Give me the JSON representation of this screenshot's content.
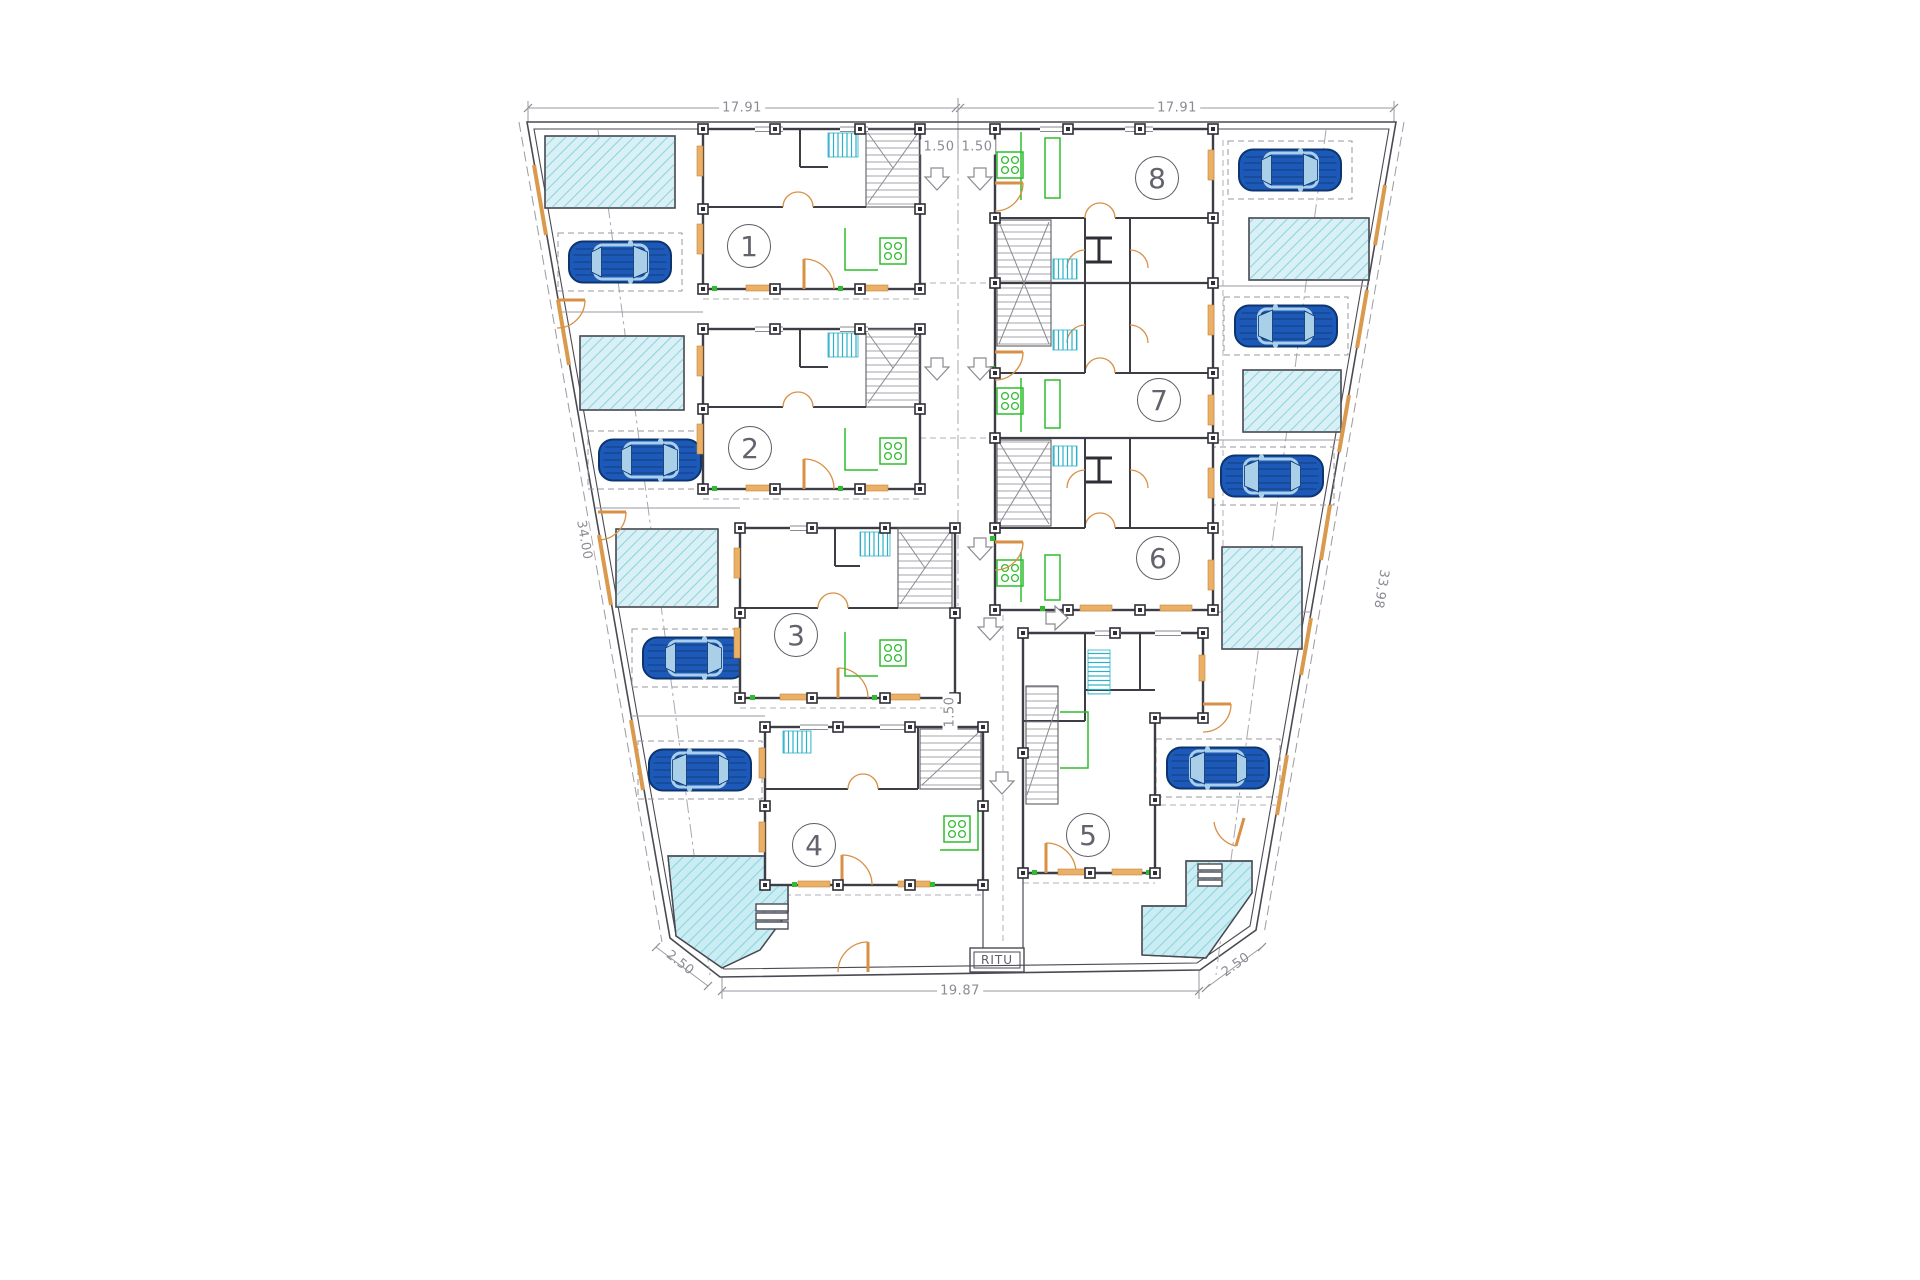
{
  "title": "Residential site plan - ground floor with 8 units",
  "units": {
    "u1": "1",
    "u2": "2",
    "u3": "3",
    "u4": "4",
    "u5": "5",
    "u6": "6",
    "u7": "7",
    "u8": "8"
  },
  "dimensions": {
    "top_left": "17.91",
    "top_right": "17.91",
    "setback_left": "1.50",
    "setback_right": "1.50",
    "side_left": "34.00",
    "side_right": "33,98",
    "center_gap": "1.50",
    "bottom": "19.87",
    "cut_left": "2.50",
    "cut_right": "2.50"
  },
  "labels": {
    "utility_box": "RITU"
  },
  "icons": {
    "car": "car-top-view-icon",
    "entry_arrow": "entry-direction-arrow-icon",
    "stairs": "staircase-icon",
    "stove": "kitchen-stove-icon",
    "pool": "swimming-pool-area"
  },
  "colors": {
    "wall": "#3d3d45",
    "door_orange": "#d89045",
    "window_sill": "#e9b066",
    "kitchen_green": "#2ebd2e",
    "fixture_cyan": "#2ab0c8",
    "pool_fill": "#d9f1f6",
    "pool_hatch": "#8fd4de",
    "car_body": "#1d59b8",
    "car_glass": "#a9cfe9",
    "dimension_gray": "#8b8b93"
  }
}
